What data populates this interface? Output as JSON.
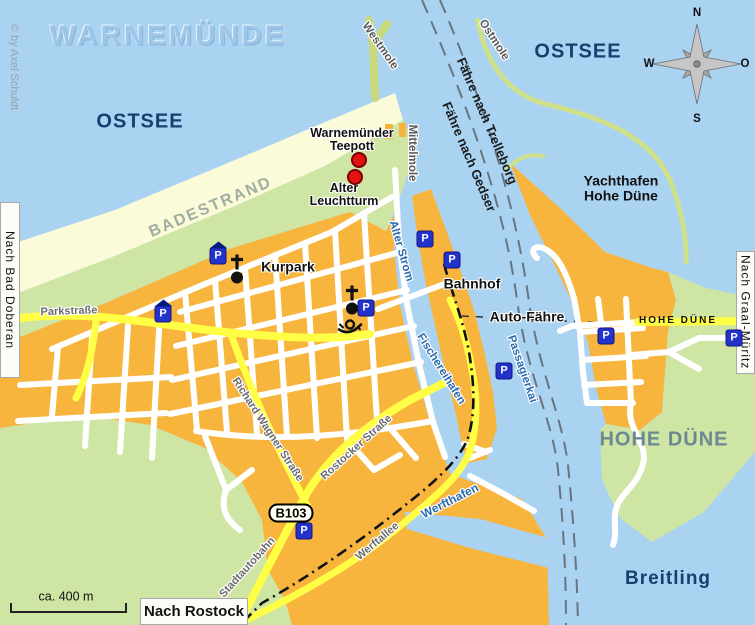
{
  "brand": {
    "watermark": "WARNEMÜNDE",
    "copyright": "© by Axel Schuldt"
  },
  "scale_bar": {
    "label": "ca. 400 m"
  },
  "compass": {
    "n": "N",
    "e": "O",
    "s": "S",
    "w": "W"
  },
  "waters": {
    "ostsee_west": "OSTSEE",
    "ostsee_east": "OSTSEE",
    "breitling": "Breitling",
    "yachthafen_line1": "Yachthafen",
    "yachthafen_line2": "Hohe Düne",
    "alter_strom": "Alter Strom",
    "fischereihafen": "Fischereihafen",
    "passagierkai": "Passagierkai",
    "werfthafen": "Werfthafen"
  },
  "areas": {
    "badestrand": "BADESTRAND",
    "hohe_duene": "HOHE DÜNE"
  },
  "streets": {
    "parkstrasse": "Parkstraße",
    "richard_wagner": "Richard Wagner Straße",
    "rostocker": "Rostocker Straße",
    "stadtautobahn": "Stadtautobahn",
    "werftallee": "Werftallee",
    "westmole": "Westmole",
    "mittelmole": "Mittelmole",
    "ostmole": "Ostmole",
    "hohe_duene_road": "HOHE DÜNE"
  },
  "routes": {
    "trelleborg": "Fähre nach Trelleborg",
    "gedser": "Fähre nach Gedser",
    "auto_faehre": "Auto-Fähre"
  },
  "pois": {
    "teepott_line1": "Warnemünder",
    "teepott_line2": "Teepott",
    "leuchtturm_line1": "Alter",
    "leuchtturm_line2": "Leuchtturm",
    "kurpark": "Kurpark",
    "bahnhof": "Bahnhof"
  },
  "exits": {
    "bad_doberan": "Nach Bad Doberan",
    "graal_mueritz": "Nach Graal-Müritz",
    "rostock": "Nach Rostock"
  },
  "road_badge": {
    "label": "B103"
  },
  "parking": {
    "label": "P"
  },
  "colors": {
    "water": "#aad3f2",
    "land": "#f7b53e",
    "beach": "#fbfbda",
    "park_green": "#cfe5a4",
    "mole_green": "#c9d87b",
    "road_yellow": "#ffff45",
    "navy": "#16406e",
    "channel_blue": "#2a6ab0",
    "parking_blue": "#2233cc",
    "poi_red": "#e51212"
  }
}
